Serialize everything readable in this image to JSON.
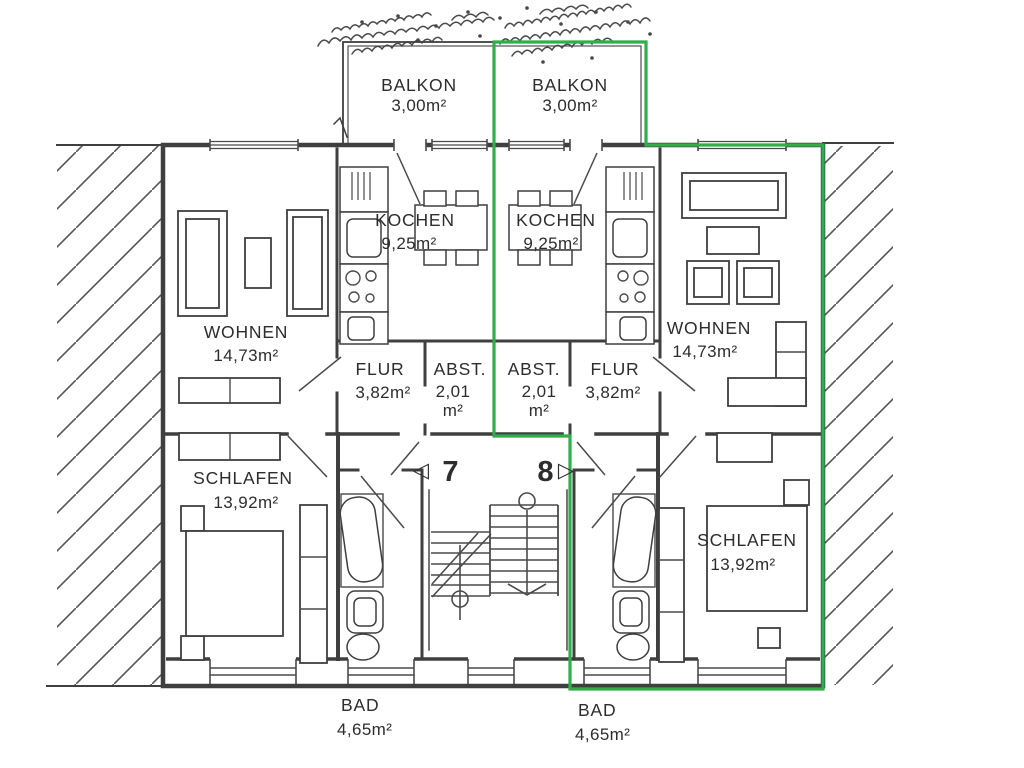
{
  "meta": {
    "drawing_type": "apartment floor plan",
    "highlight_color": "#2fae49",
    "ink_color": "#3f3f3f",
    "paper_color": "#ffffff"
  },
  "units": {
    "unit7": {
      "number": "7",
      "door_marker": "◁"
    },
    "unit8": {
      "number": "8",
      "door_marker": "▷"
    }
  },
  "rooms": {
    "balkon_left": {
      "name": "BALKON",
      "area": "3,00m²"
    },
    "balkon_right": {
      "name": "BALKON",
      "area": "3,00m²"
    },
    "kochen_left": {
      "name": "KOCHEN",
      "area": "9,25m²"
    },
    "kochen_right": {
      "name": "KOCHEN",
      "area": "9,25m²"
    },
    "wohnen_left": {
      "name": "WOHNEN",
      "area": "14,73m²"
    },
    "wohnen_right": {
      "name": "WOHNEN",
      "area": "14,73m²"
    },
    "flur_left": {
      "name": "FLUR",
      "area": "3,82m²"
    },
    "flur_right": {
      "name": "FLUR",
      "area": "3,82m²"
    },
    "abst_left": {
      "name": "ABST.",
      "area": "2,01",
      "area_unit": "m²"
    },
    "abst_right": {
      "name": "ABST.",
      "area": "2,01",
      "area_unit": "m²"
    },
    "schlafen_left": {
      "name": "SCHLAFEN",
      "area": "13,92m²"
    },
    "schlafen_right": {
      "name": "SCHLAFEN",
      "area": "13,92m²"
    },
    "bad_left": {
      "name": "BAD",
      "area": "4,65m²"
    },
    "bad_right": {
      "name": "BAD",
      "area": "4,65m²"
    }
  }
}
